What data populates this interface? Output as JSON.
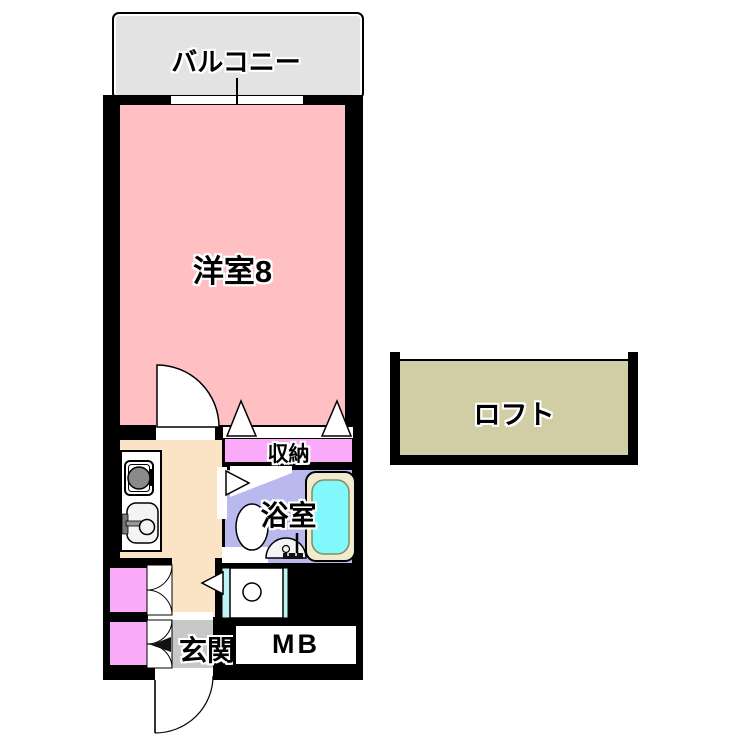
{
  "rooms": {
    "balcony": {
      "label": "バルコニー"
    },
    "western_room": {
      "label": "洋室8"
    },
    "loft": {
      "label": "ロフト"
    },
    "storage": {
      "label": "収納"
    },
    "bathroom": {
      "label": "浴室"
    },
    "entrance": {
      "label": "玄関"
    },
    "meter_box": {
      "label": "MB"
    }
  },
  "fixtures": [
    "balcony-window",
    "room-door-swing",
    "closet-folding-doors",
    "gas-stove",
    "kitchen-sink",
    "bathroom-door",
    "toilet",
    "washbasin",
    "bathtub",
    "washing-machine-space",
    "cabinet-double-doors",
    "shoe-cabinet-doors",
    "entrance-door-swing",
    "meter-box"
  ],
  "colors": {
    "wall": "#000000",
    "western_room": "#ffc0c4",
    "balcony": "#e3e3e3",
    "storage": "#faaaf8",
    "hallway": "#fbe3c5",
    "bathroom": "#b9b8ef",
    "bathtub": "#80f8fc",
    "bathtub_rim": "#f0ebcf",
    "loft": "#d1cda5",
    "entrance": "#c8c8c8",
    "washer_rail": "#bef4f2",
    "stove_burner": "#8a8a8a"
  }
}
